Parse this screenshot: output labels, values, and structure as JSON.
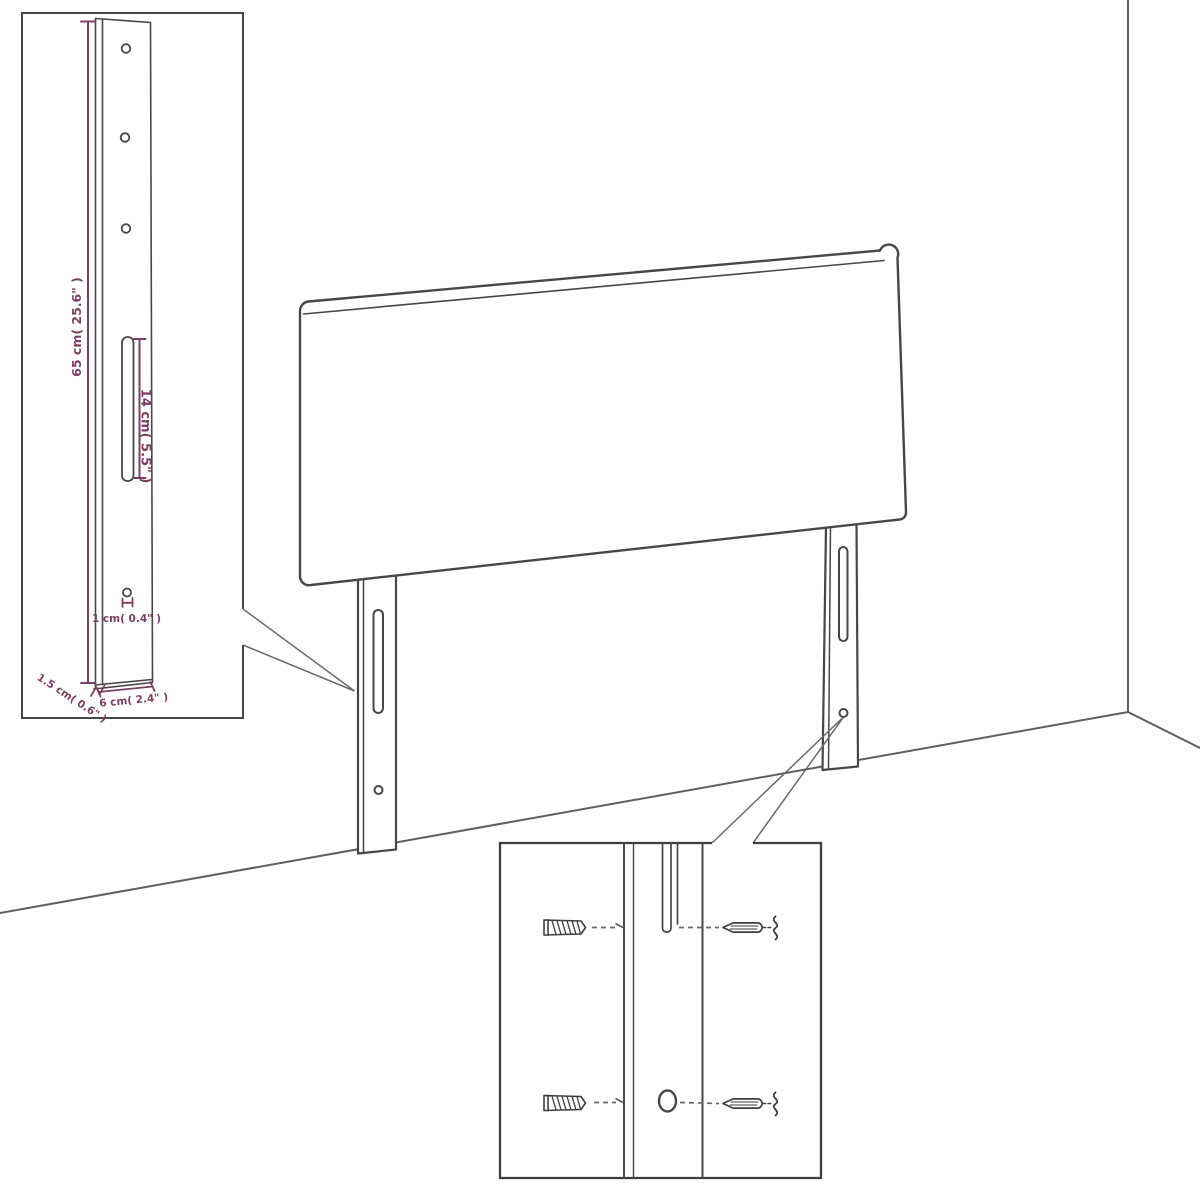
{
  "diagram": {
    "colors": {
      "background": "#ffffff",
      "line": "#474747",
      "room_line": "#5f5f5f",
      "dimension": "#7c3f63"
    },
    "dimensions": {
      "height": "65 cm( 25.6\" )",
      "slot_length": "14 cm( 5.5\" )",
      "hole_diameter": "1 cm( 0.4\" )",
      "thickness": "1.5 cm( 0.6\" )",
      "width": "6 cm( 2.4\" )"
    },
    "icons": [
      "wall-anchor-icon",
      "screw-icon",
      "wall-break-squiggle-icon"
    ]
  }
}
